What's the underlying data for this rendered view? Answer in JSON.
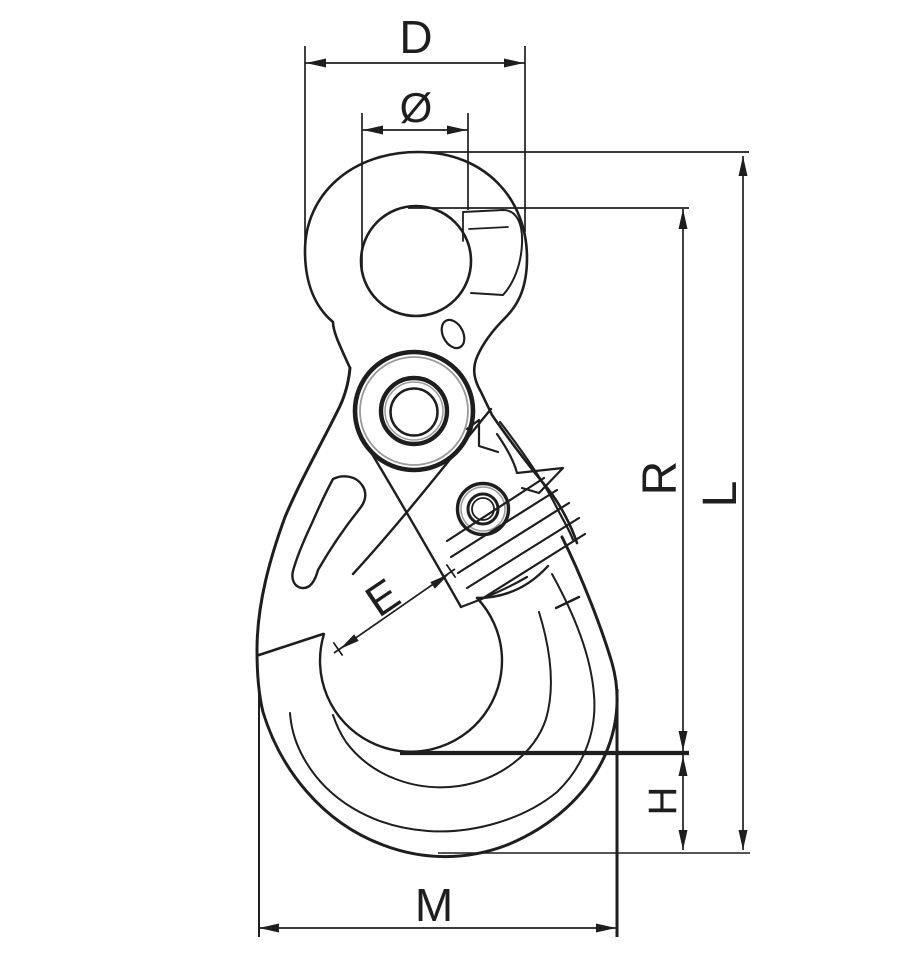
{
  "drawing": {
    "background_color": "#ffffff",
    "ink_color": "#1e1e1e",
    "shading_color": "#9a9a9a",
    "labels": {
      "D": "D",
      "diameter": "Ø",
      "R": "R",
      "L": "L",
      "E": "E",
      "H": "H",
      "M": "M"
    }
  }
}
